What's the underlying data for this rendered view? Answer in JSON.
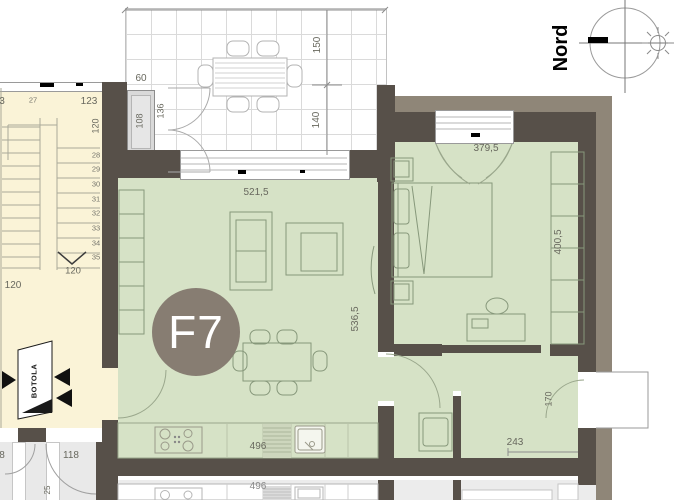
{
  "compass": {
    "label": "Nord"
  },
  "badge": {
    "label": "F7"
  },
  "terrace": {
    "width": "60",
    "planter": "108",
    "door": "136",
    "depth_a": "150",
    "depth_b": "140"
  },
  "living": {
    "width": "521,5",
    "depth": "536,5",
    "kitchen": "496"
  },
  "bedroom": {
    "width": "379,5",
    "depth": "400,5"
  },
  "hall": {
    "width": "243",
    "door": "170"
  },
  "stairs": {
    "edge": "3",
    "upper": "27",
    "top_width": "123",
    "top_depth": "120",
    "steps": [
      "28",
      "29",
      "30",
      "31",
      "32",
      "33",
      "34",
      "35"
    ],
    "arrow_width": "120",
    "bottom_width": "120",
    "lower_step": "25",
    "hatch": "BOTOLA",
    "landing": "118",
    "landing_edge": "8"
  },
  "neighbor": {
    "kitchen": "496"
  },
  "colors": {
    "room_fill": "#d6e2c6",
    "wall": "#575049",
    "wall_outer": "#8f8678",
    "stair_fill": "#faf3d7",
    "landing_fill": "#e9e9e9",
    "neighbor_fill": "#ececec",
    "badge_fill": "#877d72"
  }
}
